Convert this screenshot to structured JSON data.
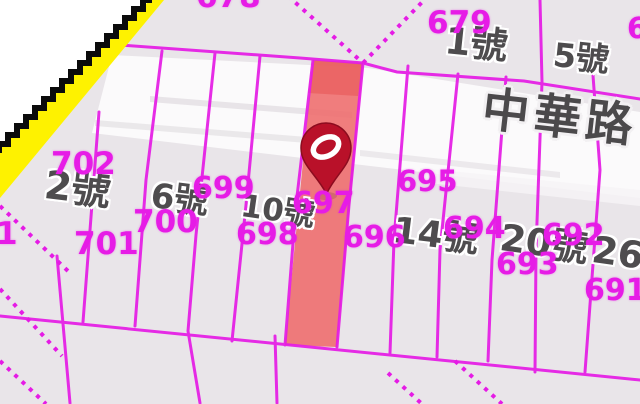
{
  "map": {
    "road_name": "中華路",
    "marker": {
      "name": "location-pin",
      "color": "#B91129"
    },
    "highlighted_parcel": {
      "label": "697",
      "fill": "#EE6B6B"
    },
    "colors": {
      "boundary_magenta": "#E51BE5",
      "background": "#E9E5E9",
      "road_white": "#FBFAFB",
      "edge_band_yellow": "#FEF200",
      "edge_line_black": "#0B0B0B",
      "address_text": "#4E4C4E",
      "parcel_text": "#E61CE6"
    },
    "parcel_labels": [
      {
        "text": "678"
      },
      {
        "text": "679"
      },
      {
        "text": "6"
      },
      {
        "text": "702"
      },
      {
        "text": "699"
      },
      {
        "text": "700"
      },
      {
        "text": "701"
      },
      {
        "text": "1"
      },
      {
        "text": "698"
      },
      {
        "text": "697"
      },
      {
        "text": "696"
      },
      {
        "text": "695"
      },
      {
        "text": "694"
      },
      {
        "text": "693"
      },
      {
        "text": "692"
      },
      {
        "text": "691"
      }
    ],
    "address_labels": [
      {
        "text": "1號"
      },
      {
        "text": "5號"
      },
      {
        "text": "2號"
      },
      {
        "text": "6號"
      },
      {
        "text": "10號"
      },
      {
        "text": "14號"
      },
      {
        "text": "20號"
      },
      {
        "text": "26號"
      }
    ]
  }
}
